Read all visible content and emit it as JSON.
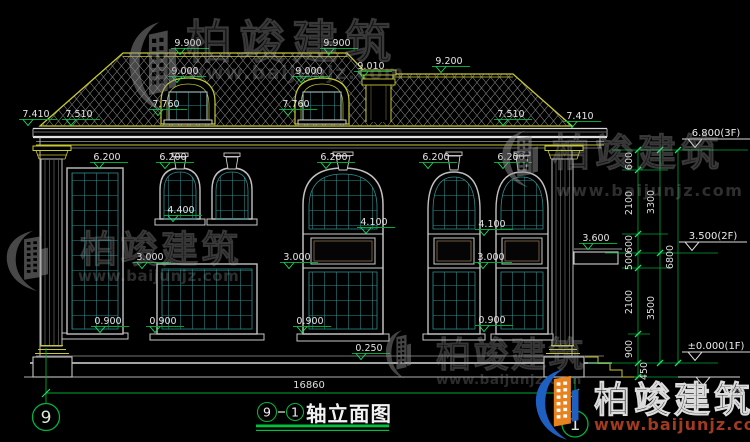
{
  "drawing": {
    "title": {
      "axis_start": "9",
      "axis_end": "1",
      "name": "轴立面图"
    },
    "overall_width": "16860",
    "axis_bubbles": {
      "left": "9",
      "right": "1"
    },
    "dim_labels": [
      {
        "t": "9.900",
        "x": 188,
        "y": 42
      },
      {
        "t": "9.900",
        "x": 337,
        "y": 42
      },
      {
        "t": "9.000",
        "x": 185,
        "y": 70
      },
      {
        "t": "9.000",
        "x": 309,
        "y": 70
      },
      {
        "t": "9.010",
        "x": 371,
        "y": 65
      },
      {
        "t": "9.200",
        "x": 449,
        "y": 60
      },
      {
        "t": "7.760",
        "x": 166,
        "y": 103
      },
      {
        "t": "7.760",
        "x": 296,
        "y": 103
      },
      {
        "t": "7.410",
        "x": 36,
        "y": 113
      },
      {
        "t": "7.510",
        "x": 79,
        "y": 113
      },
      {
        "t": "7.510",
        "x": 511,
        "y": 113
      },
      {
        "t": "7.410",
        "x": 580,
        "y": 115
      },
      {
        "t": "6.200",
        "x": 107,
        "y": 156
      },
      {
        "t": "6.200",
        "x": 173,
        "y": 156
      },
      {
        "t": "6.200",
        "x": 334,
        "y": 156
      },
      {
        "t": "6.200",
        "x": 436,
        "y": 156
      },
      {
        "t": "6.200",
        "x": 511,
        "y": 156
      },
      {
        "t": "4.400",
        "x": 181,
        "y": 209
      },
      {
        "t": "4.100",
        "x": 374,
        "y": 221
      },
      {
        "t": "4.100",
        "x": 492,
        "y": 223
      },
      {
        "t": "3.600",
        "x": 596,
        "y": 237
      },
      {
        "t": "3.000",
        "x": 150,
        "y": 256
      },
      {
        "t": "3.000",
        "x": 297,
        "y": 256
      },
      {
        "t": "3.000",
        "x": 491,
        "y": 256
      },
      {
        "t": "0.900",
        "x": 108,
        "y": 320
      },
      {
        "t": "0.900",
        "x": 163,
        "y": 320
      },
      {
        "t": "0.900",
        "x": 310,
        "y": 320
      },
      {
        "t": "0.900",
        "x": 492,
        "y": 319
      },
      {
        "t": "0.250",
        "x": 369,
        "y": 347
      }
    ],
    "vdim_labels": [
      {
        "t": "600",
        "x": 632,
        "y": 161
      },
      {
        "t": "2100",
        "x": 632,
        "y": 203
      },
      {
        "t": "600",
        "x": 632,
        "y": 244
      },
      {
        "t": "500",
        "x": 632,
        "y": 261
      },
      {
        "t": "2100",
        "x": 632,
        "y": 302
      },
      {
        "t": "900",
        "x": 632,
        "y": 349
      },
      {
        "t": "450",
        "x": 647,
        "y": 371
      },
      {
        "t": "3300",
        "x": 654,
        "y": 202
      },
      {
        "t": "3500",
        "x": 654,
        "y": 308
      },
      {
        "t": "6800",
        "x": 673,
        "y": 257
      }
    ],
    "elevation_marks": [
      {
        "t": "6.800(3F)",
        "x": 716,
        "y": 132
      },
      {
        "t": "3.500(2F)",
        "x": 713,
        "y": 235
      },
      {
        "t": "±0.000(1F)",
        "x": 716,
        "y": 345
      }
    ]
  },
  "watermark": {
    "brand": "柏竣建筑",
    "url": "www.baijunjz.com",
    "reg": "(筑)"
  },
  "colors": {
    "background": "#000000",
    "line_white": "#d4d4d4",
    "accent_yellow": "#c8c832",
    "glass_teal": "#2e8f8f",
    "dim_green": "#00a838",
    "tick_green": "#19e060",
    "logo_blue": "#1e5fc2",
    "logo_orange": "#e8821e",
    "url_red": "#a03a20"
  }
}
